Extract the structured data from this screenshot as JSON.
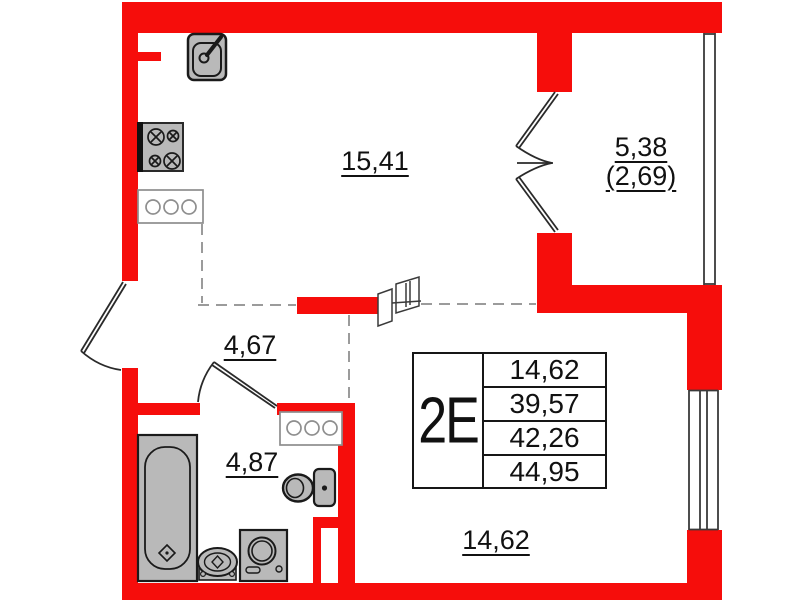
{
  "title": "apartment floor plan 2E",
  "unit": {
    "label": "2E"
  },
  "info_table": {
    "rows": [
      "14,62",
      "39,57",
      "42,26",
      "44,95"
    ]
  },
  "room_labels": {
    "living": "15,41",
    "balcony_full": "5,38",
    "balcony_counted": "(2,69)",
    "hallway": "4,67",
    "bathroom": "4,87",
    "bedroom": "14,62"
  },
  "colors": {
    "wall_red": "#f60d0b",
    "fixture_grey": "#b9b9b9",
    "line_black": "#1a1a1a",
    "counter_grey": "#8e8e8e",
    "dash_grey": "#9b9b9b"
  },
  "icons": {
    "kitchen-sink-icon": "rounded-square-basin-with-faucet-lever",
    "stove-icon": "four-burner-cooktop-circles-with-cross",
    "kitchen-counter-icon": "rect-with-three-circles",
    "bathroom-counter-icon": "rect-with-three-circles",
    "bathtub-icon": "rect-with-rounded-tub-and-drain-diamond",
    "washbasin-icon": "oval-basin-with-drain-diamond",
    "washing-machine-icon": "square-front-loader-drum",
    "toilet-icon": "bowl-ellipse-with-cistern",
    "entrance-door-icon": "single-swing-door-arc",
    "bathroom-door-icon": "single-swing-door-arc",
    "balcony-door-icon": "double-french-door-arcs",
    "sliding-door-icon": "two-offset-panels",
    "balcony-window-icon": "double-glazing-lines",
    "window-icon": "quad-glazing-lines"
  }
}
